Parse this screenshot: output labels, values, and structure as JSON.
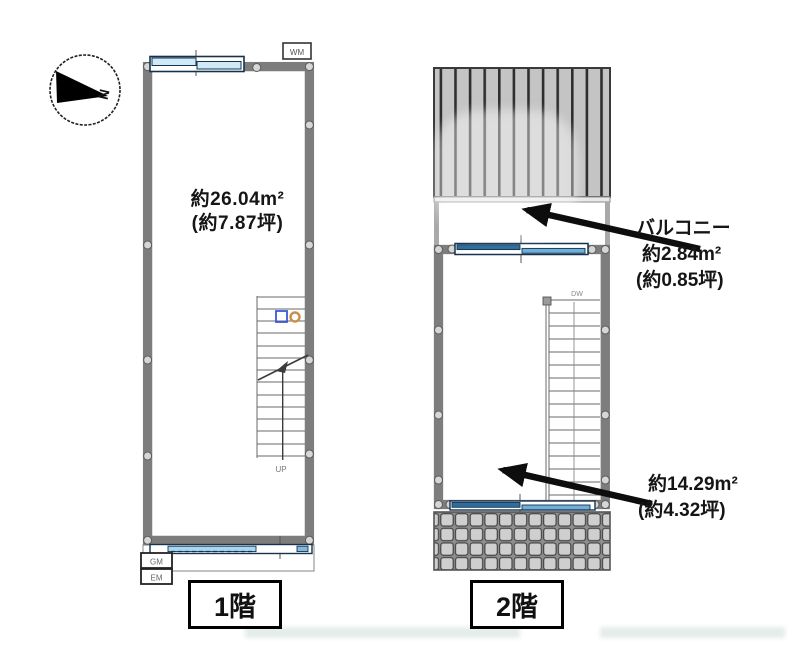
{
  "compass": {
    "north_label": "N"
  },
  "floor1": {
    "label": "1階",
    "area_sqm": "約26.04m²",
    "area_tsubo": "(約7.87坪)",
    "washing_machine_label": "WM",
    "gas_meter_label": "GM",
    "electric_meter_label": "EM",
    "stairs_up_label": "UP"
  },
  "floor2": {
    "label": "2階",
    "stairs_down_label": "DW",
    "balcony_label": "バルコニー",
    "balcony_area_sqm": "約2.84m²",
    "balcony_area_tsubo": "(約0.85坪)",
    "room_area_sqm": "約14.29m²",
    "room_area_tsubo": "(約4.32坪)"
  },
  "colors": {
    "wall": "#7d7d7d",
    "window_frame": "#16324f",
    "window_glass_light": "#cfe9f7",
    "window_glass_blue": "#2e6e9e",
    "balcony_deck": "#c4c4c4",
    "roof_tile": "#cfcfcf",
    "arrow": "#0d0d0d"
  }
}
